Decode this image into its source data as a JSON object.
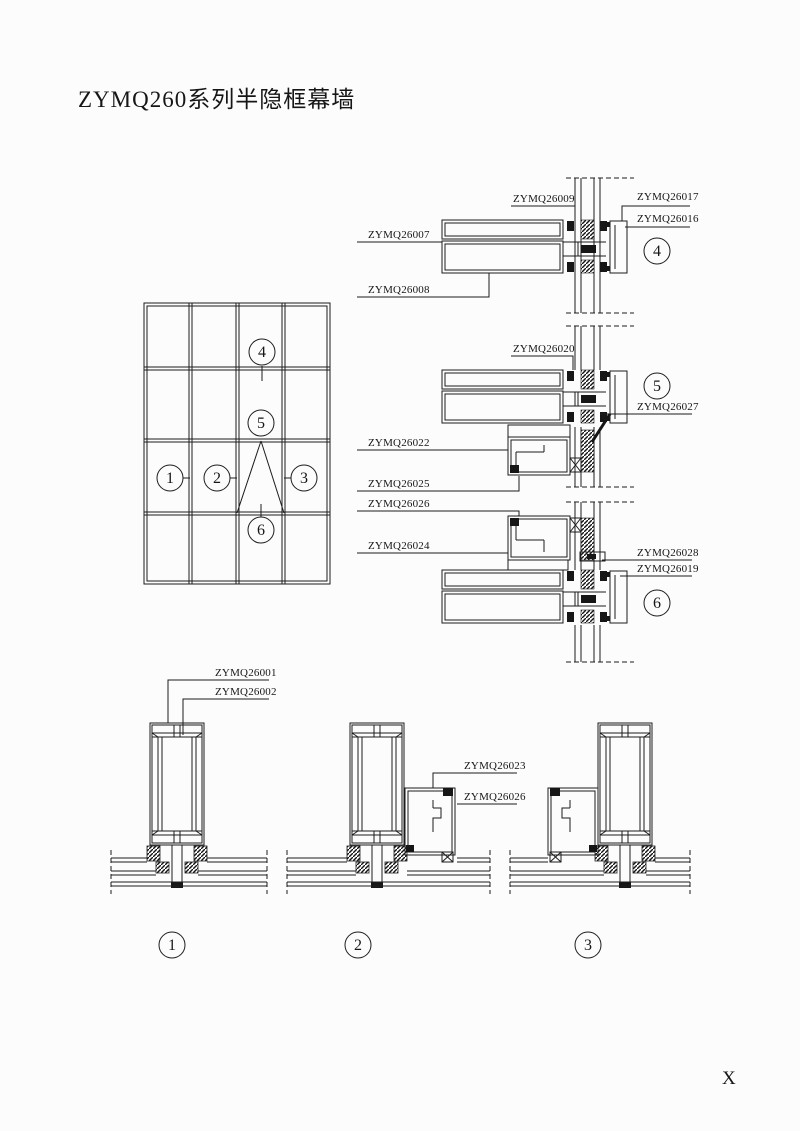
{
  "title": "ZYMQ260系列半隐框幕墙",
  "footer_mark": "X",
  "colors": {
    "line": "#1c1c1c",
    "paper": "#fcfcfc"
  },
  "elevation": {
    "callouts": [
      "1",
      "2",
      "3",
      "4",
      "5",
      "6"
    ]
  },
  "vertical_sections": [
    {
      "number": "4",
      "labels": {
        "top": "ZYMQ26009",
        "right_top": "ZYMQ26017",
        "right_mid": "ZYMQ26016",
        "left_top": "ZYMQ26007",
        "left_bottom": "ZYMQ26008"
      }
    },
    {
      "number": "5",
      "labels": {
        "top": "ZYMQ26020",
        "right": "ZYMQ26027",
        "left_top": "ZYMQ26022",
        "left_mid": "ZYMQ26025",
        "left_bottom": "ZYMQ26026"
      }
    },
    {
      "number": "6",
      "labels": {
        "left": "ZYMQ26024",
        "right_top": "ZYMQ26028",
        "right_bottom": "ZYMQ26019"
      }
    }
  ],
  "horizontal_sections": [
    {
      "number": "1",
      "labels": {
        "mullion": "ZYMQ26001",
        "insert": "ZYMQ26002"
      }
    },
    {
      "number": "2",
      "labels": {
        "frame": "ZYMQ26023",
        "sash": "ZYMQ26026"
      }
    },
    {
      "number": "3",
      "labels": {}
    }
  ]
}
